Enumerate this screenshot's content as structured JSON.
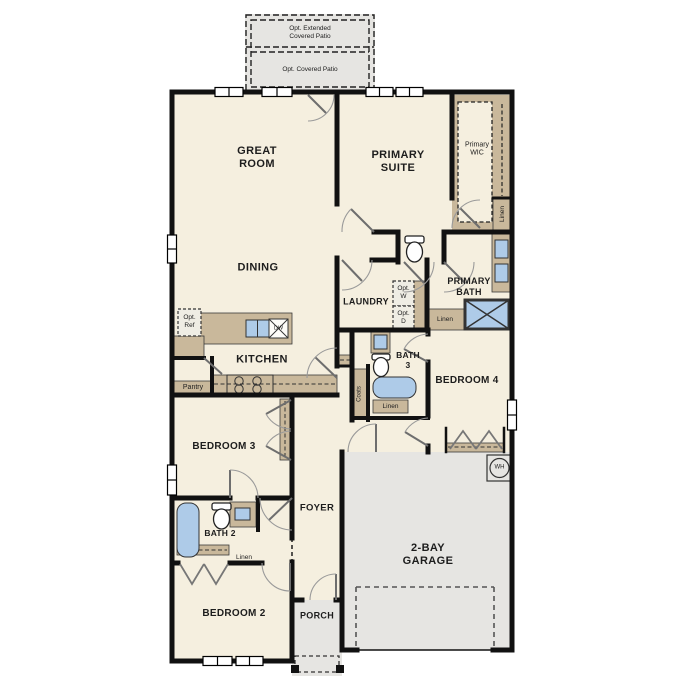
{
  "title": "Single-story floor plan",
  "colors": {
    "background": "#ffffff",
    "floor": "#f5efdf",
    "wall": "#111111",
    "cabinet_tan": "#c9b89b",
    "fixture_blue": "#aecbe8",
    "concrete_gray": "#e6e5e2"
  },
  "rooms": {
    "great_room": "GREAT\nROOM",
    "primary_suite": "PRIMARY\nSUITE",
    "primary_wic": "Primary\nWIC",
    "dining": "DINING",
    "laundry": "LAUNDRY",
    "primary_bath": "PRIMARY\nBATH",
    "kitchen": "KITCHEN",
    "bath_3": "BATH\n3",
    "bedroom_4": "BEDROOM 4",
    "bedroom_3": "BEDROOM 3",
    "foyer": "FOYER",
    "bath_2": "BATH 2",
    "bedroom_2": "BEDROOM 2",
    "porch": "PORCH",
    "garage": "2-BAY\nGARAGE"
  },
  "options": {
    "extended_patio": "Opt. Extended\nCovered Patio",
    "covered_patio": "Opt. Covered Patio",
    "refrigerator": "Opt.\nRef",
    "washer": "Opt.\nW",
    "dryer": "Opt.\nD"
  },
  "closets": {
    "pantry": "Pantry",
    "coats": "Coats",
    "linen": "Linen"
  },
  "appliances": {
    "dishwasher": "DW",
    "water_heater": "WH"
  }
}
